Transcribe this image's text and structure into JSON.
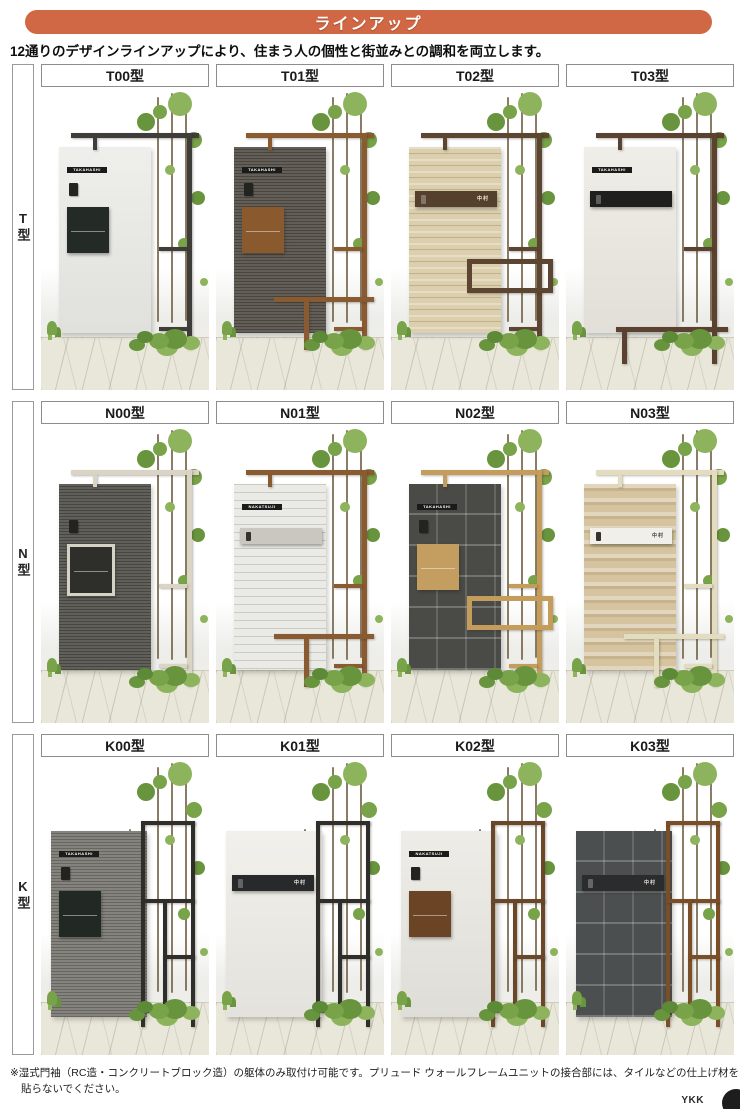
{
  "banner": {
    "label": "ラインアップ",
    "color": "#d06845"
  },
  "intro": "12通りのデザインラインアップにより、住まう人の個性と街並みとの調和を両立します。",
  "rows": [
    {
      "side_label": "T型",
      "photo_h": 301,
      "cells": [
        {
          "label": "T00型",
          "name": "TAKAHASHI",
          "name_style": "bar",
          "wall": {
            "color": "#e9e9e5",
            "texture": "plain"
          },
          "frame": {
            "color": "#3e3d39",
            "layout": "overhead"
          },
          "mailbox": {
            "type": "boxy",
            "color": "#242b26",
            "text": "#ffffff"
          },
          "lower": "none"
        },
        {
          "label": "T01型",
          "name": "TAKAHASHI",
          "name_style": "bar",
          "wall": {
            "color": "#57524b",
            "texture": "hlines"
          },
          "frame": {
            "color": "#8a5a31",
            "layout": "overhead"
          },
          "mailbox": {
            "type": "boxy",
            "color": "#8a5a2e",
            "text": "#ffffff"
          },
          "lower": "bench"
        },
        {
          "label": "T02型",
          "name": "中村",
          "name_style": "onbox",
          "wall": {
            "color": "#dccfae",
            "texture": "stone"
          },
          "frame": {
            "color": "#5d4631",
            "layout": "overhead"
          },
          "mailbox": {
            "type": "wide",
            "color": "#54402c",
            "text": "#f2ead8"
          },
          "lower": "box"
        },
        {
          "label": "T03型",
          "name": "TAKAHASHI",
          "name_style": "bar",
          "wall": {
            "color": "#eae8e0",
            "texture": "plain"
          },
          "frame": {
            "color": "#5a4130",
            "layout": "overhead"
          },
          "mailbox": {
            "type": "wide",
            "color": "#1f1f1d",
            "text": "#dddddd"
          },
          "lower": "bench-low"
        }
      ]
    },
    {
      "side_label": "N型",
      "photo_h": 297,
      "cells": [
        {
          "label": "N00型",
          "name": "",
          "name_style": "none",
          "wall": {
            "color": "#54534e",
            "texture": "hlines"
          },
          "frame": {
            "color": "#d9d4c4",
            "layout": "overhead"
          },
          "mailbox": {
            "type": "boxy",
            "color": "#2e2e2a",
            "text": "#ffffff",
            "border": "#d5d2c6"
          },
          "lower": "none"
        },
        {
          "label": "N01型",
          "name": "NAKATSUJI",
          "name_style": "bar",
          "wall": {
            "color": "#eaeae7",
            "texture": "brick"
          },
          "frame": {
            "color": "#8a5a31",
            "layout": "overhead"
          },
          "mailbox": {
            "type": "wide",
            "color": "#c9c7bf",
            "text": "#3a3a38"
          },
          "lower": "bench"
        },
        {
          "label": "N02型",
          "name": "TAKAHASHI",
          "name_style": "bar",
          "wall": {
            "color": "#4a4a47",
            "texture": "tile"
          },
          "frame": {
            "color": "#c49c5c",
            "layout": "overhead"
          },
          "mailbox": {
            "type": "boxy",
            "color": "#c49d60",
            "text": "#ffffff"
          },
          "lower": "box"
        },
        {
          "label": "N03型",
          "name": "中村",
          "name_style": "onbox",
          "wall": {
            "color": "#d5c49f",
            "texture": "stripes"
          },
          "frame": {
            "color": "#e3dcbf",
            "layout": "overhead"
          },
          "mailbox": {
            "type": "wide",
            "color": "#f0efe9",
            "text": "#44403a"
          },
          "lower": "bench"
        }
      ]
    },
    {
      "side_label": "K型",
      "photo_h": 296,
      "cells": [
        {
          "label": "K00型",
          "name": "TAKAHASHI",
          "name_style": "bar",
          "wall": {
            "color": "#7b7a74",
            "texture": "hlines"
          },
          "frame": {
            "color": "#2f2e2b",
            "layout": "side-grid"
          },
          "mailbox": {
            "type": "boxy",
            "color": "#222823",
            "text": "#ffffff"
          },
          "lower": "none"
        },
        {
          "label": "K01型",
          "name": "中村",
          "name_style": "onbox",
          "wall": {
            "color": "#edebe5",
            "texture": "plain"
          },
          "frame": {
            "color": "#2f2e2b",
            "layout": "side-grid"
          },
          "mailbox": {
            "type": "wide",
            "color": "#28292b",
            "text": "#e8e6df"
          },
          "lower": "none"
        },
        {
          "label": "K02型",
          "name": "NAKATSUJI",
          "name_style": "bar",
          "wall": {
            "color": "#e8e6e0",
            "texture": "plain"
          },
          "frame": {
            "color": "#6b4729",
            "layout": "side-grid"
          },
          "mailbox": {
            "type": "boxy",
            "color": "#6b4426",
            "text": "#ffffff"
          },
          "lower": "none"
        },
        {
          "label": "K03型",
          "name": "中村",
          "name_style": "onbox",
          "wall": {
            "color": "#4c4f50",
            "texture": "tile"
          },
          "frame": {
            "color": "#7a4e27",
            "layout": "side-grid"
          },
          "mailbox": {
            "type": "wide",
            "color": "#2b2c2e",
            "text": "#e3e1da"
          },
          "lower": "none"
        }
      ]
    }
  ],
  "footnote": "※湿式門袖（RC造・コンクリートブロック造）の躯体のみ取付け可能です。プリュード ウォールフレームユニットの接合部には、タイルなどの仕上げ材を貼らないでください。",
  "brand": "YKK",
  "scene_colors": {
    "greens": [
      "#79a348",
      "#8db45c",
      "#67943c",
      "#5d8a36"
    ],
    "trunk": "#75654a",
    "plate_bar": "#1b1b19"
  }
}
